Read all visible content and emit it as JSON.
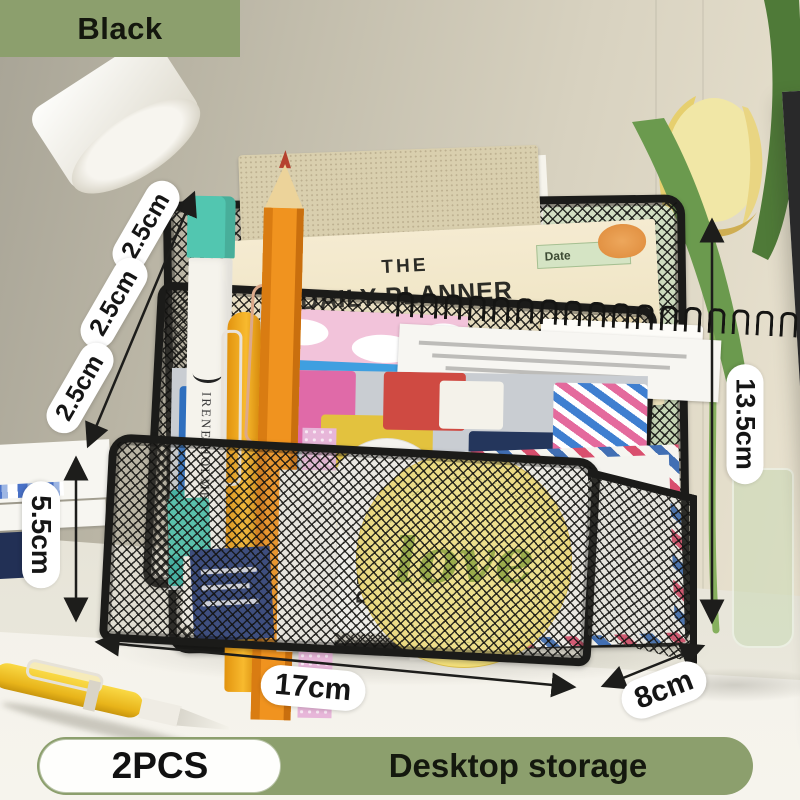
{
  "badge": {
    "label": "Black"
  },
  "annotations": {
    "slot_gap_1": "2.5cm",
    "slot_gap_2": "2.5cm",
    "slot_gap_3": "2.5cm",
    "front_height": "5.5cm",
    "back_height": "13.5cm",
    "width": "17cm",
    "depth": "8cm"
  },
  "banner": {
    "count": "2PCS",
    "title": "Desktop storage"
  },
  "items": {
    "planner": {
      "the": "THE",
      "title": "DAILY PLANNER",
      "date": "Date"
    },
    "marker": {
      "brand": "IRENE HOLMES"
    },
    "details_card": {
      "text": "DETAILS"
    },
    "love_sticker": {
      "text": "love"
    },
    "washi_box": {
      "logo": "NI"
    }
  },
  "colors": {
    "badge-green": "#8c9f6d",
    "mesh-black": "#1b1b19",
    "planner-cream": "#f2e7c6",
    "love-yellow": "#f3dc6b",
    "marker-teal": "#52c6b0",
    "pencil-orange": "#f0931f",
    "pen-yellow": "#f0c024"
  }
}
